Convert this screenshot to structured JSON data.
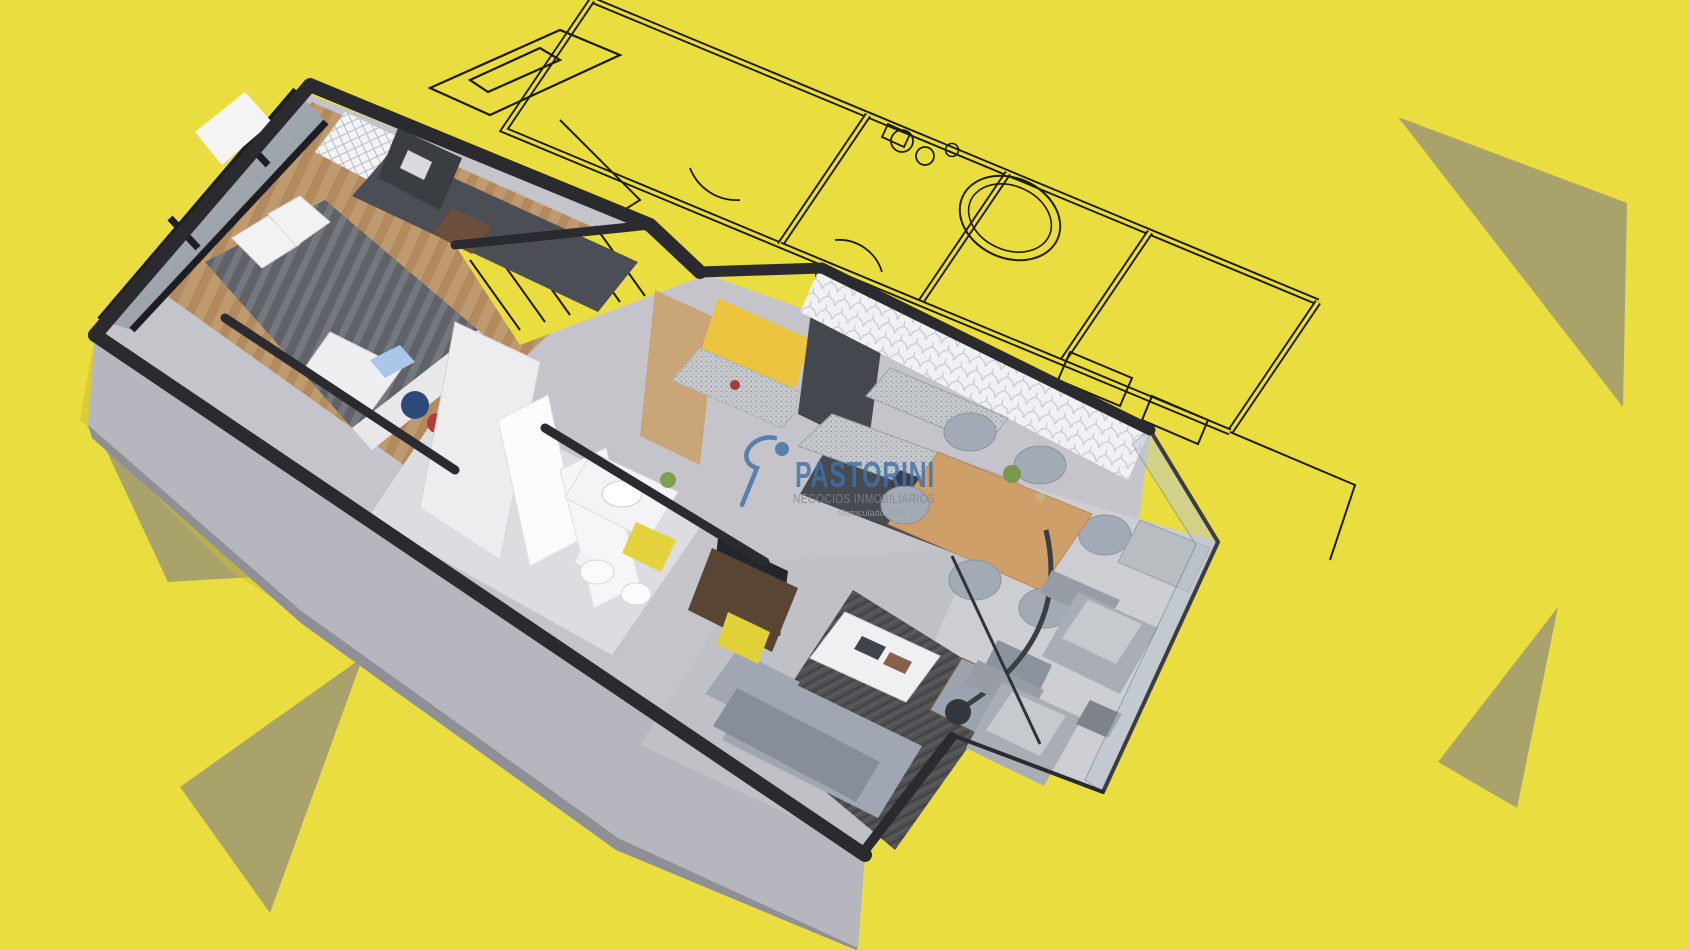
{
  "scene": {
    "description": "3D isometric cutaway render of a one-bedroom apartment placed over a 2D blueprint sketch on a bright yellow background with olive triangle accents",
    "background_color": "#E9DD40",
    "triangle_accent_color": "#A9A36B",
    "blueprint_line_color": "#1D1C08",
    "wall_cap_color": "#2A2A2F"
  },
  "watermark": {
    "brand": "PASTORINI",
    "tagline": "NEGOCIOS INMOBILIARIOS",
    "registration": "Matriculado 4017",
    "brand_color": "#4270A8",
    "tagline_color": "#81878E",
    "registration_color": "#999FA6",
    "icon": "running-figure-icon"
  },
  "render": {
    "style": "3d-isometric-cutaway-floor-plan",
    "rooms": [
      "bedroom",
      "closet-hall",
      "bathroom",
      "kitchen",
      "dining-area",
      "living-room",
      "balcony"
    ],
    "furniture": [
      "double-bed",
      "wardrobe",
      "window-wall",
      "bathroom-vanity",
      "toilet",
      "bidet",
      "kitchen-island",
      "kitchen-counter",
      "dining-table",
      "dining-chairs",
      "sofa",
      "coffee-table",
      "armchair",
      "tv-unit",
      "floor-lamp",
      "balcony-armchairs",
      "balcony-side-table"
    ],
    "accent_colors": {
      "wood_floor": "#C09A6F",
      "cabinet_yellow": "#E4D23C",
      "backsplash_yellow": "#ECC33E",
      "rug": "#515154",
      "sofa_gray": "#A0A7B2",
      "table_wood": "#CF9F6A"
    }
  }
}
